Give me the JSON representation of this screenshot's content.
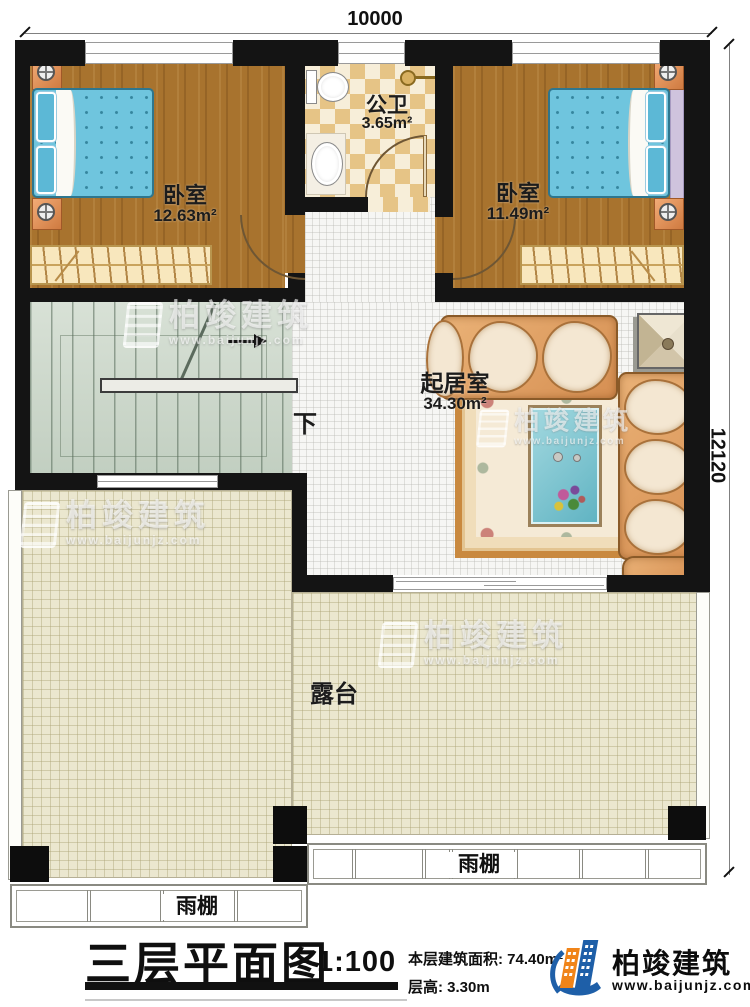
{
  "dimensions": {
    "width_label": "10000",
    "height_label": "12120"
  },
  "rooms": {
    "bedroom_left": {
      "label": "卧室",
      "area": "12.63m²"
    },
    "bedroom_right": {
      "label": "卧室",
      "area": "11.49m²"
    },
    "bathroom": {
      "label": "公卫",
      "area": "3.65m²"
    },
    "living_room": {
      "label": "起居室",
      "area": "34.30m²"
    },
    "terrace": {
      "label": "露台"
    },
    "canopy_left": {
      "label": "雨棚"
    },
    "canopy_right": {
      "label": "雨棚"
    },
    "stairs": {
      "direction_label": "下"
    }
  },
  "title_block": {
    "title": "三层平面图",
    "scale": "1:100",
    "floor_area_label": "本层建筑面积: 74.40m²",
    "floor_height_label": "层高: 3.30m"
  },
  "brand": {
    "name": "柏竣建筑",
    "website": "www.baijunjz.com",
    "blue": "#1e5fa8",
    "orange": "#f08419"
  },
  "watermark": {
    "name": "柏竣建筑",
    "website": "www.baijunjz.com"
  }
}
